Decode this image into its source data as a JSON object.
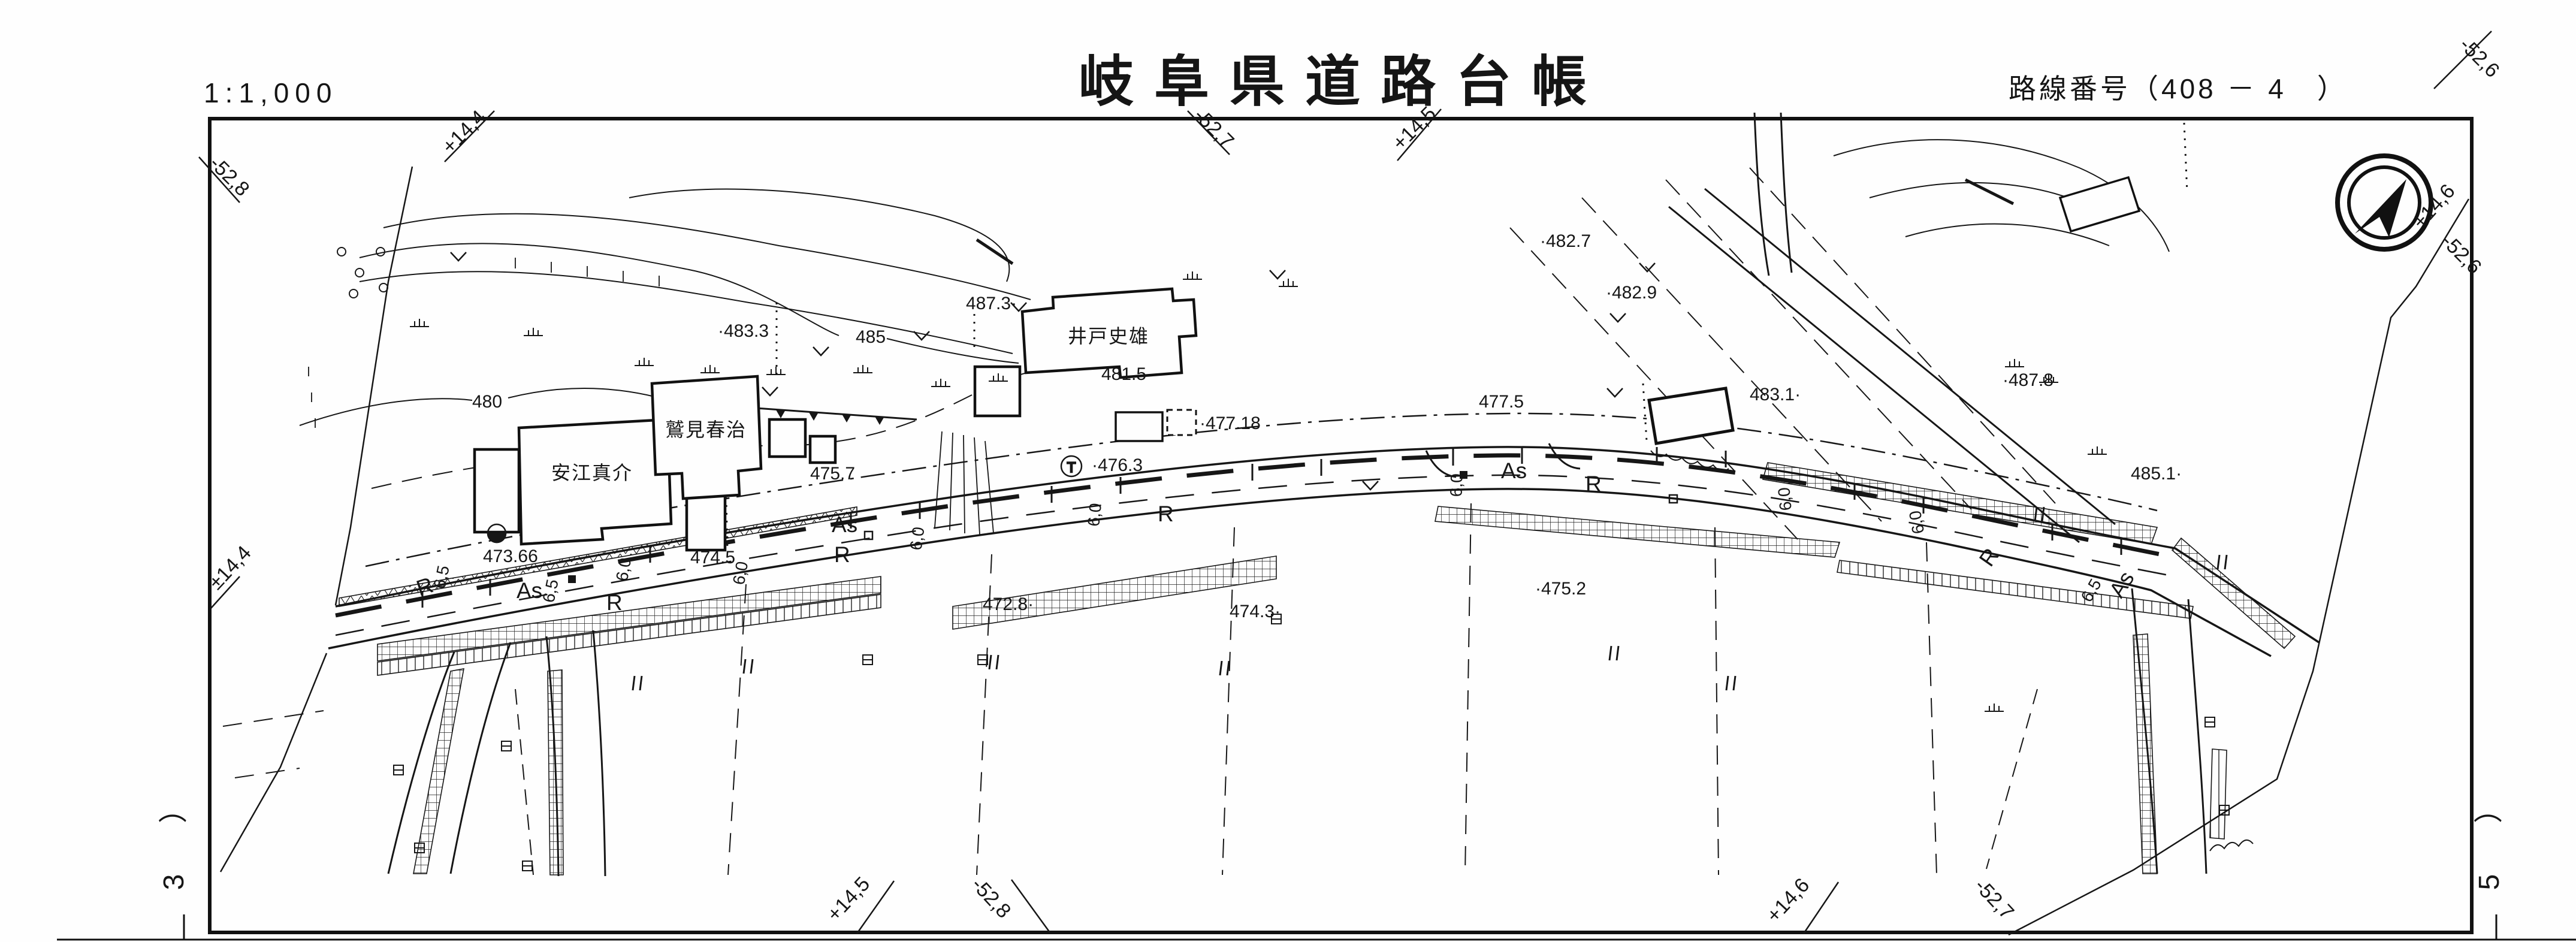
{
  "header": {
    "scale": "1:1,000",
    "title": "岐阜県道路台帳",
    "route_label": "路線番号",
    "route_value": "（408 － 4　）"
  },
  "sheet": {
    "page_left": "3",
    "page_right": "5",
    "paren": "）",
    "edge_labels": [
      {
        "text": "-52,8"
      },
      {
        "text": "+14,4"
      },
      {
        "text": "-52,7"
      },
      {
        "text": "+14,5"
      },
      {
        "text": "-52,6"
      },
      {
        "text": "+14,6"
      },
      {
        "text": "-52,6"
      },
      {
        "text": "±14,4"
      },
      {
        "text": "+14,5"
      },
      {
        "text": "-52,8"
      },
      {
        "text": "+14,6"
      },
      {
        "text": "-52,7"
      }
    ]
  },
  "map": {
    "buildings": [
      {
        "name": "安江真介"
      },
      {
        "name": "鷲見春治"
      },
      {
        "name": "井戸史雄"
      }
    ],
    "elevations": [
      {
        "text": "480",
        "value": 480
      },
      {
        "text": "·483.3",
        "value": 483.3
      },
      {
        "text": "485",
        "value": 485
      },
      {
        "text": "487.3·",
        "value": 487.3
      },
      {
        "text": "481.5",
        "value": 481.5
      },
      {
        "text": "·477.18",
        "value": 477.18
      },
      {
        "text": "477.5",
        "value": 477.5
      },
      {
        "text": "·476.3",
        "value": 476.3
      },
      {
        "text": "475.7",
        "value": 475.7
      },
      {
        "text": "474.5",
        "value": 474.5
      },
      {
        "text": "473.66",
        "value": 473.66
      },
      {
        "text": "472.8·",
        "value": 472.8
      },
      {
        "text": "474.3·",
        "value": 474.3
      },
      {
        "text": "·475.2",
        "value": 475.2
      },
      {
        "text": "·482.7",
        "value": 482.7
      },
      {
        "text": "·482.9",
        "value": 482.9
      },
      {
        "text": "483.1·",
        "value": 483.1
      },
      {
        "text": "·487.8",
        "value": 487.8
      },
      {
        "text": "485.1·",
        "value": 485.1
      }
    ],
    "road": {
      "surface_label": "As",
      "edge_label": "R",
      "widths": [
        "6,5",
        "6,0"
      ]
    },
    "symbols": {
      "utility_pole": "T"
    }
  }
}
